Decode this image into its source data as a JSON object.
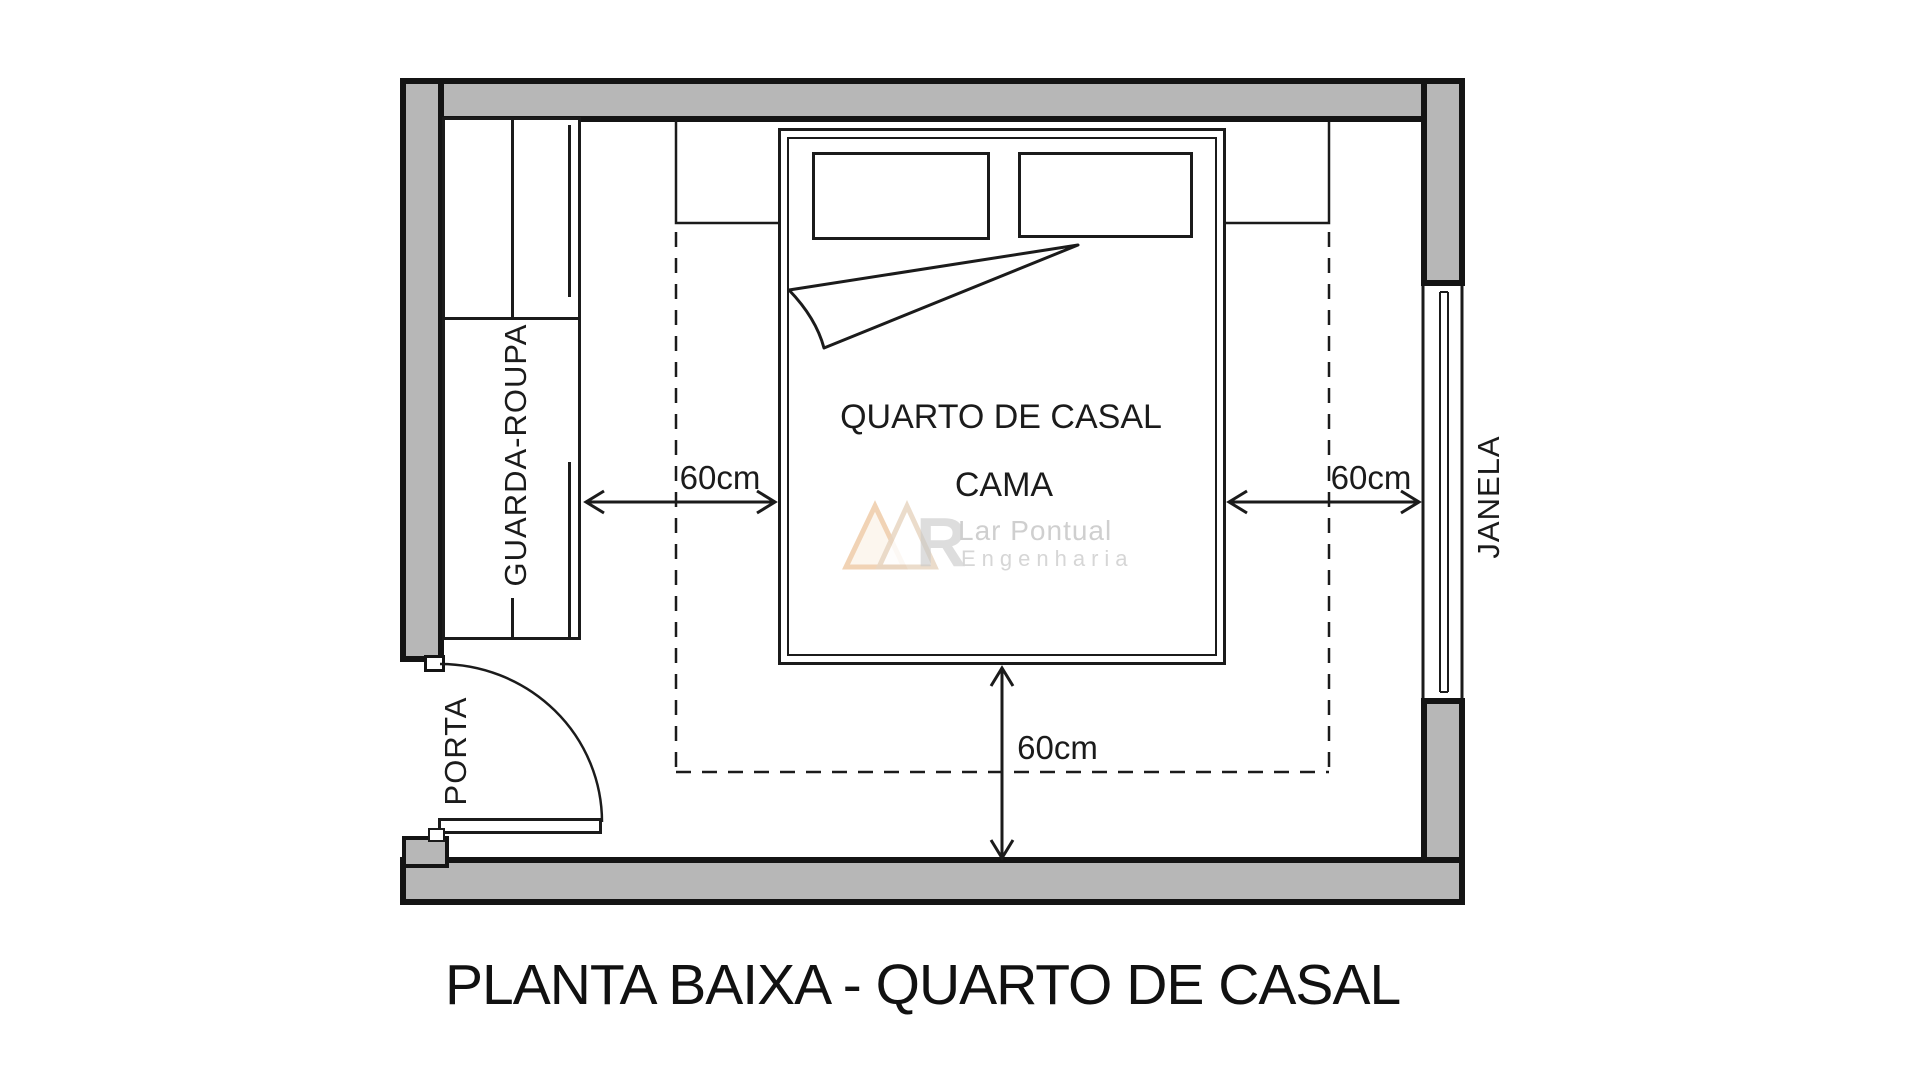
{
  "title": "PLANTA BAIXA - QUARTO DE CASAL",
  "room": {
    "name_label": "QUARTO DE CASAL",
    "bed_label": "CAMA"
  },
  "furniture": {
    "wardrobe_label": "GUARDA-ROUPA"
  },
  "openings": {
    "door_label": "PORTA",
    "window_label": "JANELA"
  },
  "dimensions": {
    "left_clearance": "60cm",
    "right_clearance": "60cm",
    "bottom_clearance": "60cm"
  },
  "watermark": {
    "logo_letter": "R",
    "line1": "Lar Pontual",
    "line2": "Engenharia"
  },
  "colors": {
    "wall_fill": "#b7b7b7",
    "line": "#1b1b1b",
    "watermark_orange": "#eec9a3",
    "watermark_text": "#cfcfcf"
  }
}
